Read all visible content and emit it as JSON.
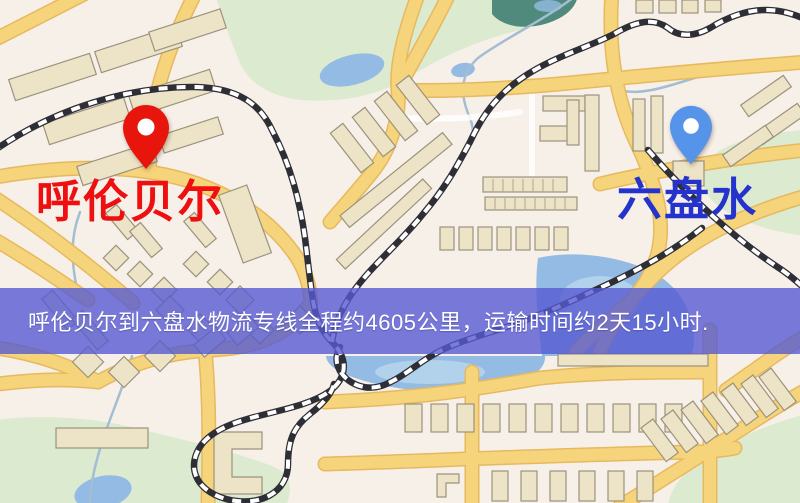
{
  "theme": {
    "map_bg": "#f7f0e9",
    "road_color": "#f6d47c",
    "water_color": "#93bbe4",
    "park_color": "#dcead0",
    "building_color": "#ede3c6",
    "railway_color": "#2e2e36",
    "banner_bg": "rgba(86,90,210,0.8)",
    "banner_text_color": "#ffffff",
    "origin_pin_color": "#e8150d",
    "origin_label_color": "#ee1010",
    "dest_pin_color": "#5694ea",
    "dest_label_color": "#2433cb"
  },
  "markers": {
    "origin": {
      "label": "呼伦贝尔"
    },
    "destination": {
      "label": "六盘水"
    }
  },
  "banner": {
    "text": "呼伦贝尔到六盘水物流专线全程约4605公里，运输时间约2天15小时."
  },
  "route": {
    "origin": "呼伦贝尔",
    "destination": "六盘水",
    "distance_km": "4605",
    "duration": "2天15小时"
  }
}
